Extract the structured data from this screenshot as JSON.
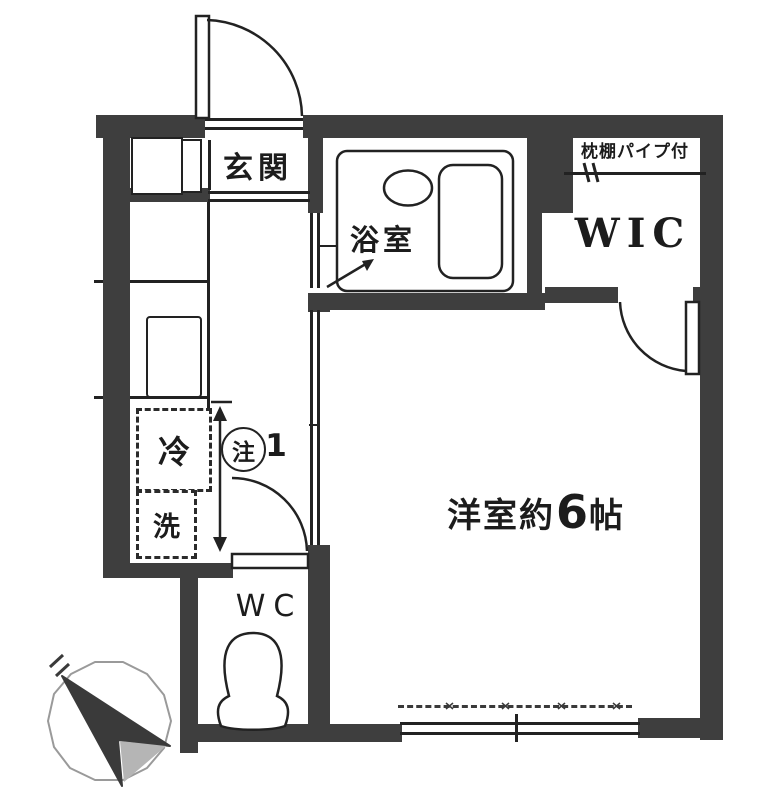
{
  "plan": {
    "type": "apartment-floor-plan"
  },
  "rooms": {
    "entrance": {
      "label": "玄関"
    },
    "bathroom": {
      "label": "浴室"
    },
    "wic": {
      "label": "WIC",
      "note": "枕棚パイプ付"
    },
    "main_room": {
      "label_prefix": "洋室約",
      "size_number": "6",
      "label_suffix": "帖"
    },
    "wc": {
      "label": "WC"
    },
    "kitchen": {
      "fridge_label": "冷",
      "washer_label": "洗"
    }
  },
  "annotations": {
    "note_symbol": "注",
    "note_number": "1"
  },
  "colors": {
    "wall": "#3e3e3e",
    "line": "#222222",
    "background": "#ffffff",
    "compass_fill": "#3a3a3a",
    "compass_shadow": "#b5b5b5",
    "compass_ring": "#9a9a9a"
  }
}
